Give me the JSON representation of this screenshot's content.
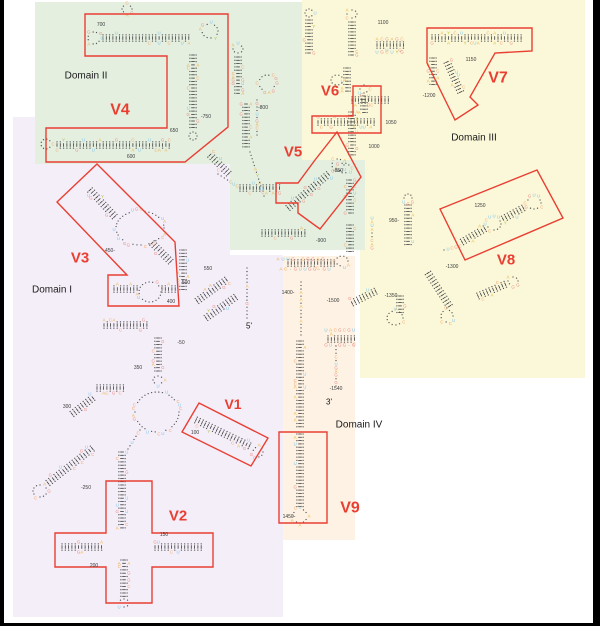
{
  "canvas": {
    "width": 600,
    "height": 626,
    "background": "#ffffff",
    "frame_color": "#000000"
  },
  "accent_red": "#e93f33",
  "domains": [
    {
      "id": "domain-1",
      "label": "Domain I",
      "fill": "#f4eef8",
      "label_color": "#1a1a1a"
    },
    {
      "id": "domain-2",
      "label": "Domain II",
      "fill": "#e4efe0",
      "label_color": "#1a1a1a"
    },
    {
      "id": "domain-3",
      "label": "Domain III",
      "fill": "#fbf8d9",
      "label_color": "#1a1a1a"
    },
    {
      "id": "domain-4",
      "label": "Domain IV",
      "fill": "#fdf2e3",
      "label_color": "#1a1a1a"
    }
  ],
  "variable_regions": [
    "V1",
    "V2",
    "V3",
    "V4",
    "V5",
    "V6",
    "V7",
    "V8",
    "V9"
  ],
  "terminal_labels": {
    "five_prime": "5'",
    "three_prime": "3'"
  },
  "position_markers": [
    "700",
    "-750",
    "650",
    "600",
    "-800",
    "-850",
    "-900",
    "950-",
    "1000",
    "1050",
    "1100",
    "1150",
    "-1200",
    "1250",
    "-1300",
    "-1350",
    "1400-",
    "-1500",
    "-1540",
    "1450-",
    "450-",
    "500",
    "550",
    "400",
    "-50",
    "350",
    "300",
    "100",
    "-250",
    "150",
    "200"
  ],
  "nucleotide_colors": {
    "A": "#ECAF3C",
    "C": "#F2A469",
    "G": "#EA8B80",
    "U": "#7FC4E8",
    "R": "#B5BD3A",
    "Y": "#B5BD3A",
    "-": "#9a9a9a",
    "=": "#9a9a9a"
  },
  "skeleton_colors": {
    "rung": "#3b3b3b",
    "dot": "#555555",
    "marker_text": "#3c3c3c"
  },
  "sequence_fragments": {
    "hub_top": "AUUG-CGGAG",
    "hub_bottom": "AC-GUUGG-GU",
    "helix_top": "ACGAGC",
    "helix_bottom": "UGCUYG",
    "v9_top": "UACGCGU",
    "v9_bottom": "GU-GG-G",
    "loop_pool": "AGCUUAGCGUCAAUGGACUCGAUGCCAGUAY"
  }
}
